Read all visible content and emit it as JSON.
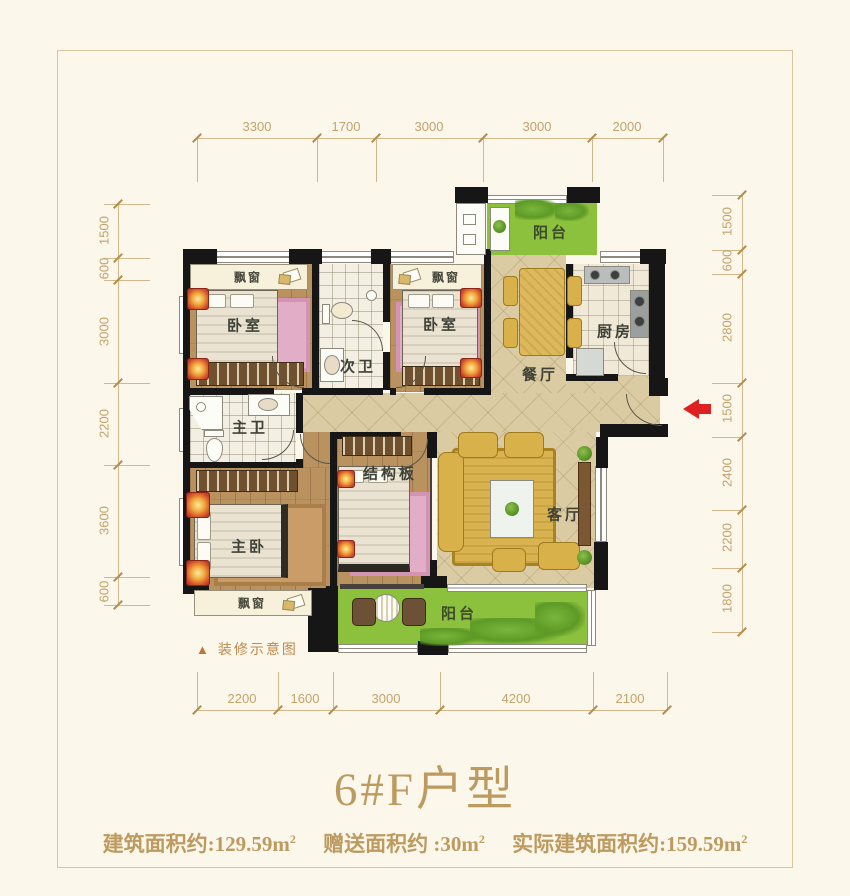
{
  "title": "6#F户型",
  "area_line": {
    "building_label": "建筑面积约:129.59m",
    "gift_label": "赠送面积约 :30m",
    "actual_label": "实际建筑面积约:159.59m",
    "sup": "2"
  },
  "caption": {
    "marker": "▲",
    "text": "装修示意图"
  },
  "dimensions": {
    "top": [
      "3300",
      "1700",
      "3000",
      "3000",
      "2000"
    ],
    "bottom": [
      "2200",
      "1600",
      "3000",
      "4200",
      "2100"
    ],
    "left": [
      "1500",
      "600",
      "3000",
      "2200",
      "3600",
      "600"
    ],
    "right": [
      "1500",
      "600",
      "2800",
      "1500",
      "2400",
      "2200",
      "1800"
    ]
  },
  "rooms": {
    "balcony_top": "阳台",
    "balcony_bottom": "阳台",
    "bedroom_top_left": "卧室",
    "bedroom_top_right": "卧室",
    "second_bath": "次卫",
    "kitchen": "厨房",
    "dining": "餐厅",
    "master_bath": "主卫",
    "master_bedroom": "主卧",
    "structure_slab": "结构板",
    "living": "客厅",
    "bay_window": "飘窗"
  },
  "colors": {
    "accent_gold": "#c2a06b",
    "title_gold": "#bd9b60",
    "balcony_green": "#8cc13e",
    "arrow_red": "#e02020",
    "wall_black": "#161616"
  }
}
